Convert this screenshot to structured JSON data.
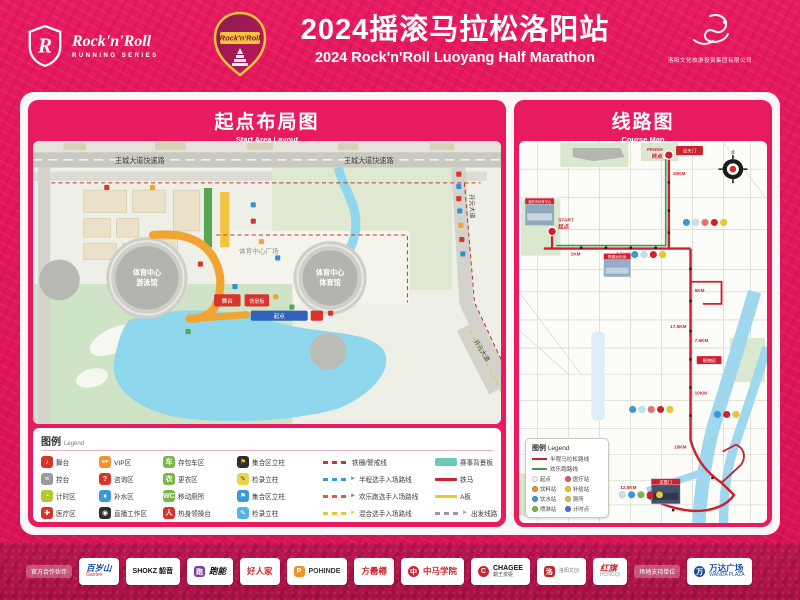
{
  "header": {
    "brand_top": "Rock'n'Roll",
    "brand_sub": "RUNNING SERIES",
    "badge_text": "Rock'n'Roll",
    "title_cn": "2024摇滚马拉松洛阳站",
    "title_en": "2024 Rock'n'Roll Luoyang Half Marathon",
    "org_name": "洛阳文化旅游投资集团有限公司"
  },
  "start_panel": {
    "title_cn": "起点布局图",
    "title_en": "Start Area Layout",
    "map": {
      "road_expressway": "王城大道快速路",
      "road_main": "王城大道",
      "road_east": "开元大道",
      "road_east_diag": "开元大道",
      "sports_center": "体育中心",
      "natatorium": "游泳馆",
      "gymnasium": "体育馆",
      "plaza": "体育中心广场",
      "start_arch": "起点",
      "stage": "舞台",
      "backdrop": "背景板"
    },
    "legend": {
      "title_cn": "图例",
      "title_en": "Legend",
      "items": [
        {
          "kind": "icon",
          "glyph": "♪",
          "bg": "#d8332c",
          "fg": "#ffffff",
          "label": "舞台"
        },
        {
          "kind": "icon",
          "glyph": "VIP",
          "bg": "#f0922b",
          "fg": "#ffffff",
          "label": "VIP区"
        },
        {
          "kind": "icon",
          "glyph": "车",
          "bg": "#7ab648",
          "fg": "#ffffff",
          "label": "存包车区"
        },
        {
          "kind": "icon",
          "glyph": "⚑",
          "bg": "#2e2e2e",
          "fg": "#f5c518",
          "label": "集合区立柱"
        },
        {
          "kind": "dash",
          "color": "#c0392b",
          "arrow": false,
          "label": "铁栅/警戒线"
        },
        {
          "kind": "block",
          "color": "#6fc8bc",
          "label": "赛事背景板"
        },
        {
          "kind": "icon",
          "glyph": "≡",
          "bg": "#9a9a9a",
          "fg": "#ffffff",
          "label": "控台"
        },
        {
          "kind": "icon",
          "glyph": "?",
          "bg": "#d8332c",
          "fg": "#ffffff",
          "label": "咨询区"
        },
        {
          "kind": "icon",
          "glyph": "衣",
          "bg": "#7ab648",
          "fg": "#ffffff",
          "label": "更衣区"
        },
        {
          "kind": "icon",
          "glyph": "✎",
          "bg": "#e8d44d",
          "fg": "#6b5b10",
          "label": "检录立柱"
        },
        {
          "kind": "dash",
          "color": "#3a9ad9",
          "arrow": true,
          "label": "半程选手入场路线"
        },
        {
          "kind": "solid",
          "color": "#cf2030",
          "label": "铁马"
        },
        {
          "kind": "icon",
          "glyph": "◔",
          "bg": "#b6c82e",
          "fg": "#ffffff",
          "label": "计时区"
        },
        {
          "kind": "icon",
          "glyph": "♦",
          "bg": "#3a9ad9",
          "fg": "#ffffff",
          "label": "补水区"
        },
        {
          "kind": "icon",
          "glyph": "WC",
          "bg": "#7ab648",
          "fg": "#ffffff",
          "label": "移动厕所"
        },
        {
          "kind": "icon",
          "glyph": "⚑",
          "bg": "#3a9ad9",
          "fg": "#ffffff",
          "label": "集合区立柱"
        },
        {
          "kind": "dash",
          "color": "#e05a3a",
          "arrow": true,
          "label": "欢乐跑选手入场路线"
        },
        {
          "kind": "solid",
          "color": "#e8c832",
          "label": "A板"
        },
        {
          "kind": "icon",
          "glyph": "✚",
          "bg": "#d8332c",
          "fg": "#ffffff",
          "label": "医疗区"
        },
        {
          "kind": "icon",
          "glyph": "◉",
          "bg": "#2e2e2e",
          "fg": "#ffffff",
          "label": "直播工作区"
        },
        {
          "kind": "icon",
          "glyph": "人",
          "bg": "#d8332c",
          "fg": "#ffffff",
          "label": "热身领操台"
        },
        {
          "kind": "icon",
          "glyph": "✎",
          "bg": "#56b4e2",
          "fg": "#ffffff",
          "label": "检录立柱"
        },
        {
          "kind": "dash",
          "color": "#e8c832",
          "arrow": true,
          "label": "混合选手入场路线"
        },
        {
          "kind": "dash",
          "color": "#9a9a9a",
          "arrow": true,
          "label": "出发线路"
        }
      ]
    }
  },
  "course_panel": {
    "title_cn": "线路图",
    "title_en": "Course Map",
    "map": {
      "start_en": "START",
      "start_cn": "起点",
      "finish_en": "FINISH",
      "finish_cn": "终点",
      "compass_north": "北",
      "km_markers": [
        "1KM",
        "2.5KM",
        "5KM",
        "7.5KM",
        "10KM",
        "12.5KM",
        "15KM",
        "17.5KM",
        "20KM"
      ],
      "landmarks": [
        "应天门",
        "洛阳市体育中心",
        "隋唐洛阳城",
        "定鼎门",
        "植物园"
      ],
      "legend": {
        "title_cn": "图例",
        "title_en": "Legend",
        "routes": [
          {
            "color": "#cf2030",
            "label": "半程马拉松路线"
          },
          {
            "color": "#3f9c45",
            "label": "欢乐跑路线"
          }
        ],
        "items": [
          {
            "color": "#f2f2f2",
            "label": "起点"
          },
          {
            "color": "#e05a5a",
            "label": "医疗站"
          },
          {
            "color": "#f0922b",
            "label": "饮料站"
          },
          {
            "color": "#e8c832",
            "label": "补给站"
          },
          {
            "color": "#3a9ad9",
            "label": "饮水站"
          },
          {
            "color": "#d8c24a",
            "label": "厕所"
          },
          {
            "color": "#7ab648",
            "label": "喷淋站"
          },
          {
            "color": "#4a6fd8",
            "label": "计时点"
          }
        ]
      }
    }
  },
  "sponsors": {
    "label_left": "官方合作伙伴",
    "label_right": "场地支持单位",
    "logos": [
      {
        "id": "ganten",
        "line1": "百岁山",
        "line2": "Ganten",
        "c1": "#1a4fa0",
        "c2": "#d42a2a",
        "icon": ""
      },
      {
        "id": "shokz",
        "line1": "SHOKZ 韶音",
        "line2": "",
        "c1": "#111111",
        "c2": "",
        "icon": ""
      },
      {
        "id": "paoneng",
        "line1": "跑能",
        "line2": "",
        "c1": "#111111",
        "c2": "",
        "icon": "#7b3fa0"
      },
      {
        "id": "haorenjia",
        "line1": "好人家",
        "line2": "",
        "c1": "#d42a2a",
        "c2": "",
        "icon": ""
      },
      {
        "id": "pohinde",
        "line1": "POHINDE",
        "line2": "",
        "c1": "#333333",
        "c2": "",
        "icon": "#f0922b"
      },
      {
        "id": "fangleizun",
        "line1": "方罍樽",
        "line2": "",
        "c1": "#c9252c",
        "c2": "",
        "icon": ""
      },
      {
        "id": "zhongma",
        "line1": "中马学院",
        "line2": "",
        "c1": "#c9252c",
        "c2": "",
        "icon": "#c9252c"
      },
      {
        "id": "chagee",
        "line1": "CHAGEE",
        "line2": "霸王茶姬",
        "c1": "#111111",
        "c2": "#555555",
        "icon": "#c9252c"
      },
      {
        "id": "luoyang-seal",
        "line1": "洛",
        "line2": "洛阳文创",
        "c1": "#ffffff",
        "c2": "#777777",
        "icon": "#c9252c"
      },
      {
        "id": "hongqi",
        "line1": "红旗",
        "line2": "HONGQI",
        "c1": "#c9252c",
        "c2": "#999999",
        "icon": ""
      },
      {
        "id": "wanda",
        "line1": "万达广场",
        "line2": "WANDA PLAZA",
        "c1": "#1a4fa0",
        "c2": "#1a4fa0",
        "icon": "#1a4fa0"
      }
    ]
  }
}
